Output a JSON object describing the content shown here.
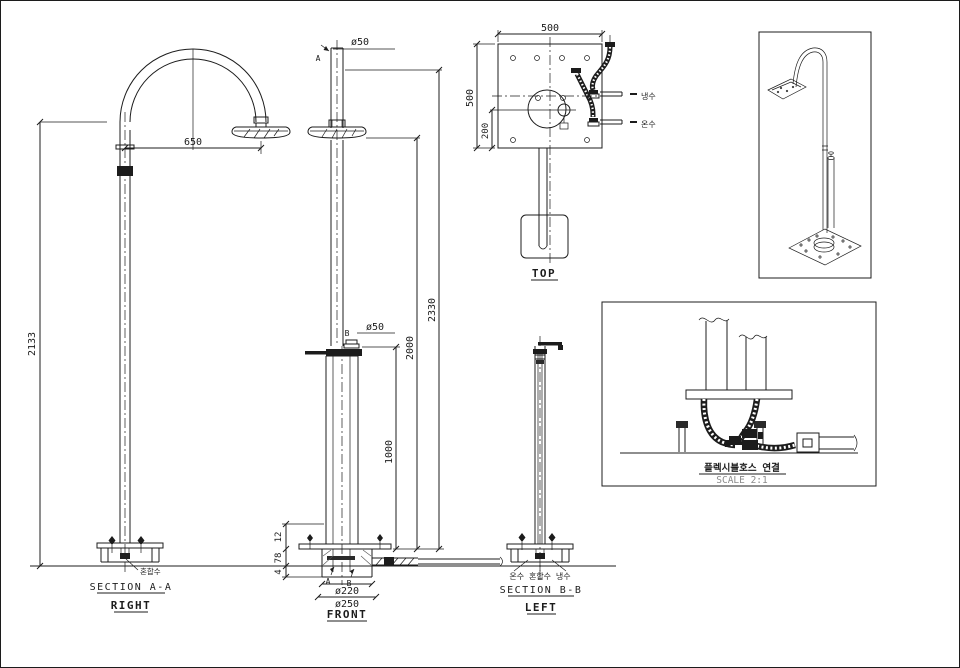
{
  "drawing": {
    "bg": "#ffffff",
    "ink": "#1c1c1c",
    "views": {
      "right": {
        "section_label": "SECTION A-A",
        "view_label": "RIGHT",
        "dim_height": "2133",
        "dim_arm": "650",
        "callout_base": "혼합수"
      },
      "front": {
        "view_label": "FRONT",
        "dim_pipe_top": "ø50",
        "dim_pipe_mid": "ø50",
        "dim_total": "2330",
        "dim_head": "2000",
        "dim_valve": "1000",
        "dim_plate": "12",
        "dim_embed": "78",
        "dim_gap": "4",
        "dim_flange": "ø220",
        "dim_base": "ø250",
        "marker_a": "A",
        "marker_b": "B"
      },
      "top": {
        "view_label": "TOP",
        "dim_width": "500",
        "dim_depth": "500",
        "dim_offset": "200",
        "callout_cold": "냉수",
        "callout_hot": "온수"
      },
      "left": {
        "section_label": "SECTION B-B",
        "view_label": "LEFT",
        "callout_pipes": "온수 혼합수 냉수"
      },
      "detail": {
        "title": "플렉시블호스 연결",
        "scale_label": "SCALE 2:1"
      }
    }
  }
}
